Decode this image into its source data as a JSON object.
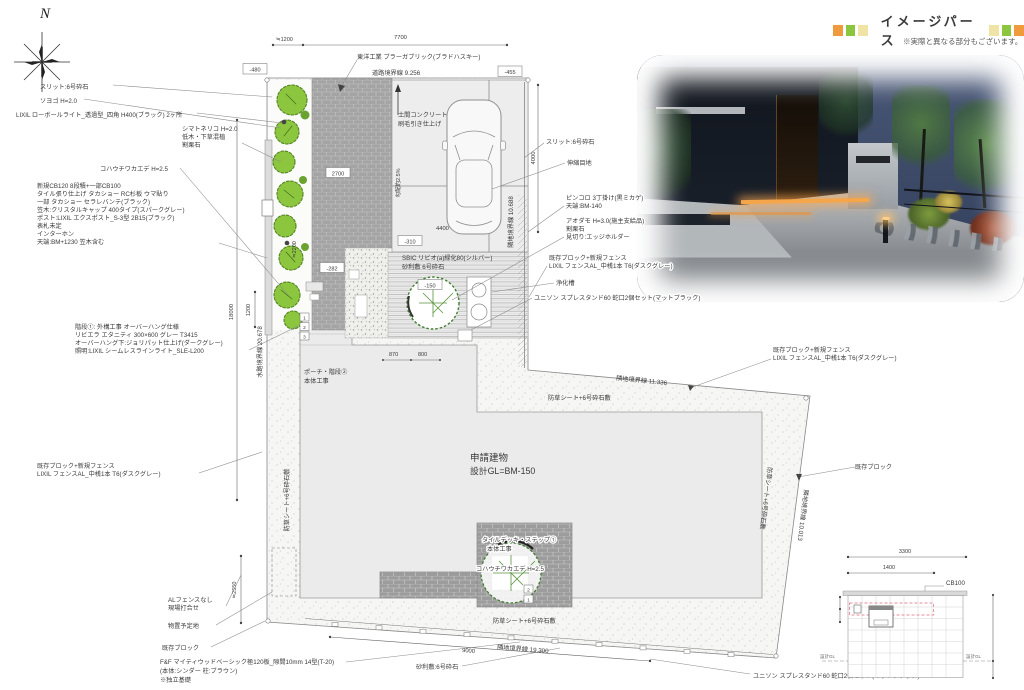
{
  "header": {
    "title": "イメージパース",
    "note": "※実際と異なる部分もございます。",
    "square_colors": [
      "#F09A3E",
      "#8CC63F",
      "#EFE3A5"
    ]
  },
  "compass": {
    "north": "N"
  },
  "plan": {
    "left": {
      "slit": "スリット:6号砕石",
      "soyogo": "ソヨゴ H=2.0",
      "lowpole": "LIXIL ローボールライト_透過型_四角 H400(ブラック) 2ヶ所",
      "shima": [
        "シマトネリコ H=2.0",
        "低木・下草混植",
        "割栗石"
      ],
      "kohauchiwa": "コハウチワカエデ H=2.5",
      "wall_spec": [
        "新規CB120 8段積+一部CB100",
        "タイル張り仕上げ タカショー RC杉板 ウマ貼り",
        "一部 タカショー セラレバンテ(ブラック)",
        "笠木:クリスタルキャップ 400タイプ(スパークグレー)",
        "ポスト:LIXIL エクスポスト_S-3型 2B15(ブラック)",
        "表札未定",
        "インターホン",
        "天端:BM+1230 笠木含む"
      ],
      "stairs": [
        "階段①: 外構工事 オーバーハング仕様",
        "リビエラ エタニティ 300×600 グレー T3415",
        "オーバーハング下:ジョリパット仕上げ(ダークグレー)",
        "照明:LIXIL シームレスラインライト_SLE-L200"
      ],
      "fence": [
        "既存ブロック+新規フェンス",
        "LIXIL フェンスAL_中桟1本 T6(ダスクグレー)"
      ],
      "al_fence": [
        "ALフェンスなし",
        "現場打合せ"
      ],
      "shed": "物置予定地",
      "existing_block": "既存ブロック",
      "ff_fence": [
        "F&F マイティウッドベーシック極120板_隙間10mm 14型(T-20)",
        "(本体:シンダー 柱:ブラウン)",
        "※独立基礎"
      ]
    },
    "top": {
      "brick": "東洋工業 ブラーガブリック(ブラドハスキー)",
      "road_boundary": "道路境界線 9.256",
      "concrete": [
        "土間コンクリート",
        "刷毛引き仕上げ"
      ]
    },
    "right": {
      "slit": "スリット:6号砕石",
      "joint": "伸縮目地",
      "pincoro": [
        "ピンコロ 3丁掛け(黒ミカゲ)",
        "天端:BM-140"
      ],
      "aodamo": [
        "アオダモ H=3.0(施主支給品)",
        "割栗石",
        "見切り:エッジホルダー"
      ],
      "fence1": [
        "既存ブロック+新規フェンス",
        "LIXIL フェンスAL_中桟1本 T6(ダスクグレー)"
      ],
      "jokaso": "浄化槽",
      "unison": "ユニソン スプレスタンド60 蛇口2個セット(マットブラック)",
      "fence2": [
        "既存ブロック+新規フェンス",
        "LIXIL フェンスAL_中桟1本 T6(ダスクグレー)"
      ],
      "existing_block": "既存ブロック"
    },
    "center": {
      "building": [
        "申請建物",
        "設計GL=BM-150"
      ],
      "deck": [
        "タイルデッキ・ステップ①",
        "本体工事"
      ],
      "kohauchiwa": "コハウチワカエデ H=2.5",
      "porch": [
        "ポーチ・階段②",
        "本体工事"
      ],
      "sbic": [
        "SBIC リビオ(a)緑化80(シルバー)",
        "砂利敷 6号砕石"
      ],
      "weed_sheet": "防草シート+6号砕石敷",
      "gravel": "砂利敷:6号砕石"
    },
    "boundary": {
      "adj_tr": "隣地境界線 11.336",
      "adj_r": "隣地境界線 10.688",
      "adj_br": "隣地境界線 10.013",
      "adj_b": "隣地境界線 19.300",
      "water": "水路境界線 20.678"
    },
    "dims": {
      "a1200": "≒1200",
      "a7700": "7700",
      "m480": "-480",
      "m455": "-455",
      "v4000": "4000",
      "b2700": "2700",
      "c4400": "4400",
      "m310": "-310",
      "m282": "-282",
      "m150": "-150",
      "a2200": "≒2200",
      "d870": "870",
      "d800": "800",
      "v18000": "18000",
      "v1200": "1200",
      "a2550": "≒2550",
      "d9000": "9000",
      "slope": "勾配約2.5%"
    },
    "steps": {
      "s1": "1",
      "s2": "2",
      "s3": "3",
      "d1": "1",
      "d2": "2"
    }
  },
  "detail": {
    "dim_top": "3300",
    "dim_mid": "1400",
    "cb": "CB100",
    "gl_left": "設計GL",
    "gl_right": "設計GL"
  }
}
